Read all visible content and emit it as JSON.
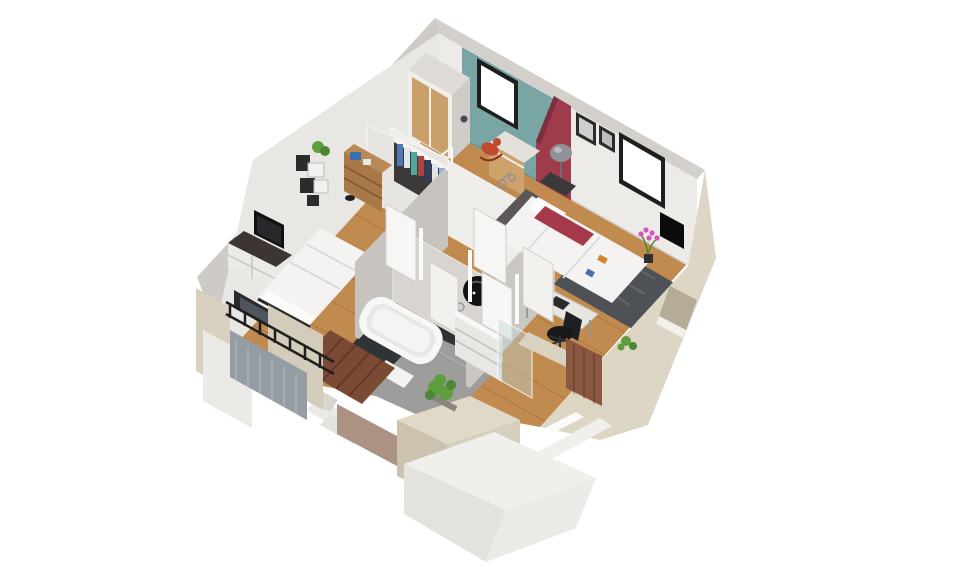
{
  "scene": {
    "type": "isometric-3d-floorplan-render",
    "description": "3D cutaway dollhouse view of an upper storey of a house, viewed from above at an angle on a white background",
    "background": "#ffffff"
  },
  "palette": {
    "teal_wall": "#79a5a5",
    "maroon_wall": "#9e3c4c",
    "maroon_dark": "#7e2f3d",
    "wood_floor": "#c18a4e",
    "plank_line": "rgba(120,70,30,0.28)",
    "wall_lit": "#edebe8",
    "wall_shadow": "#c7c3bf",
    "wall_top": "#d3d0cb",
    "exterior_beige": "#ddd6c4",
    "exterior_beige_dark": "#cbc3b0",
    "white_block": "#f0efec",
    "tile_dark": "#303336",
    "tile_gray": "#9d9e9b",
    "rug_gray": "#4e5257",
    "stairs_wood": "#7b4a34",
    "stair_tread": "#5a3123",
    "railing_black": "#1f1f1f",
    "shutter_gray": "#959ca4",
    "bed_white": "#f4f3f1",
    "pillow_red": "#a5384a",
    "crib_yellow": "#e8d3a2",
    "furniture_wood": "#a87848",
    "wardrobe_door": "#c9a06a",
    "tv_black": "#101010",
    "plant_green": "#5f9e3e",
    "orchid_pink": "#d558b8",
    "glass": "rgba(190,212,214,0.42)",
    "window_glow": "#ffffff",
    "frame_black": "#1e1e1e"
  },
  "rooms": [
    {
      "id": "nursery",
      "wall_accent": "teal",
      "furniture": [
        "wardrobe",
        "crib",
        "chest-of-drawers",
        "rocking-horse",
        "small-toys",
        "window"
      ]
    },
    {
      "id": "master-bedroom",
      "wall_accent": "maroon",
      "furniture": [
        "double-bed",
        "red-cushions",
        "dark-rug",
        "bedside-lamp",
        "two-wall-pictures",
        "open-wardrobe",
        "desk",
        "office-chair",
        "wall-tv",
        "pink-orchid",
        "window"
      ]
    },
    {
      "id": "bedroom",
      "wall_accent": "none",
      "furniture": [
        "double-bed",
        "tv-stand",
        "tv",
        "geometric-wall-shelves",
        "wooden-bookcase",
        "plant",
        "balcony-window"
      ]
    },
    {
      "id": "bathroom",
      "furniture": [
        "bathtub",
        "vanity-unit",
        "round-black-mirror",
        "wall-lamps",
        "glass-shower-screen",
        "toilet",
        "bath-mat"
      ]
    },
    {
      "id": "hallway",
      "furniture": [
        "open-doors",
        "open-closet-with-clothes",
        "closet-shelf"
      ]
    },
    {
      "id": "staircase",
      "furniture": [
        "wooden-stair-flight",
        "white-landing-steps"
      ]
    },
    {
      "id": "exterior",
      "furniture": [
        "balcony-railing",
        "roller-shutter-panel",
        "planter-shrub",
        "beige-parapet-walls",
        "window-recess",
        "wood-shutter-panel"
      ]
    }
  ]
}
